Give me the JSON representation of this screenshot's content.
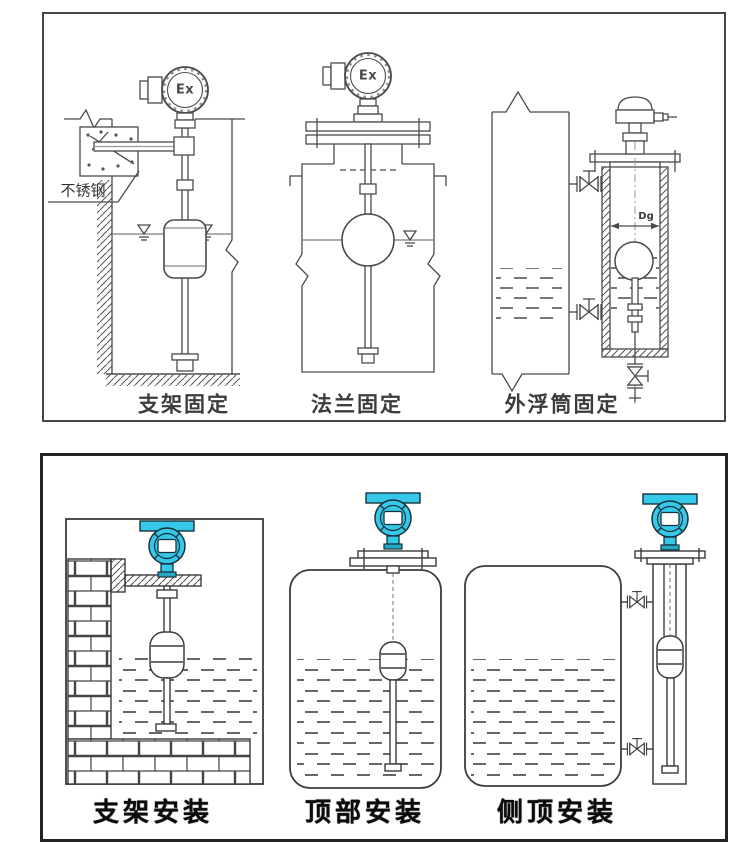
{
  "top_panel": {
    "diagrams": [
      {
        "id": "bracket-fixing",
        "caption": "支架固定",
        "labels": {
          "transmitter_mark": "Ex",
          "material": "不锈钢"
        }
      },
      {
        "id": "flange-fixing",
        "caption": "法兰固定",
        "labels": {
          "transmitter_mark": "Ex"
        }
      },
      {
        "id": "external-chamber-fixing",
        "caption": "外浮筒固定",
        "labels": {
          "diameter_mark": "Dg"
        }
      }
    ]
  },
  "bottom_panel": {
    "diagrams": [
      {
        "id": "bracket-mounting",
        "caption": "支架安装"
      },
      {
        "id": "top-mounting",
        "caption": "顶部安装"
      },
      {
        "id": "side-top-mounting",
        "caption": "侧顶安装"
      }
    ]
  },
  "colors": {
    "line": "#4a4a4a",
    "panel_border": "#3c3c3c",
    "caption": "#222222",
    "transmitter_fill": "#35c8e8",
    "transmitter_shade": "#23a8c6",
    "center_line": "#8c655c",
    "background": "#ffffff"
  }
}
